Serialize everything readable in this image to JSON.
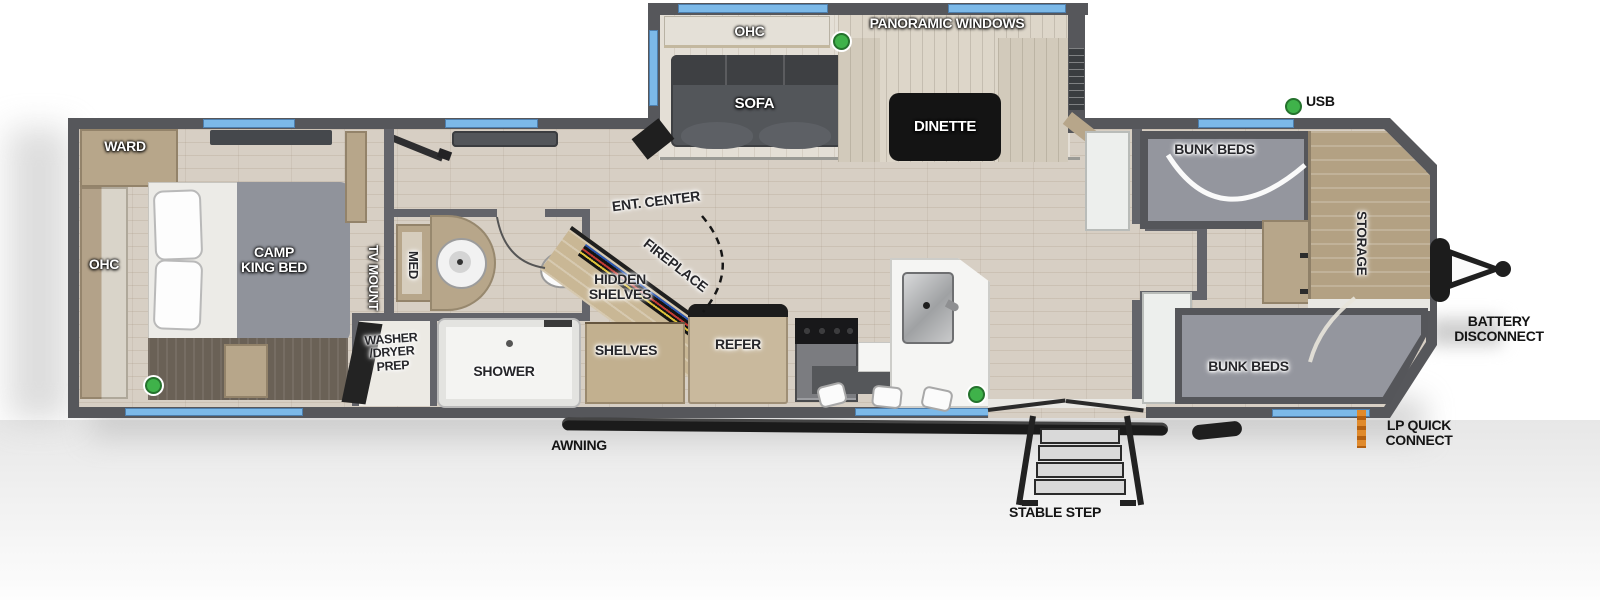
{
  "diagram_type": "travel-trailer-floorplan",
  "colors": {
    "window_blue": "#7cb9e8",
    "indicator_green": "#3fb24a",
    "lp_orange": "#dd7f1f",
    "wall_gray": "#5a5b5d",
    "floor_wood": "#d7cfc4",
    "cabinet_tan": "#b7a68a",
    "furniture_gray": "#94969e"
  },
  "labels": {
    "panoramic_windows": "PANORAMIC WINDOWS",
    "ohc_slide": "OHC",
    "sofa": "SOFA",
    "dinette": "DINETTE",
    "usb": "USB",
    "bunk_beds_upper": "BUNK BEDS",
    "storage": "STORAGE",
    "battery_disconnect": "BATTERY\nDISCONNECT",
    "bunk_beds_lower": "BUNK BEDS",
    "lp_quick_connect": "LP QUICK\nCONNECT",
    "stable_step": "STABLE STEP",
    "awning": "AWNING",
    "refer": "REFER",
    "shelves": "SHELVES",
    "hidden_shelves": "HIDDEN\nSHELVES",
    "fireplace": "FIREPLACE",
    "ent_center": "ENT. CENTER",
    "shower": "SHOWER",
    "washer_dryer_prep": "WASHER\n/DRYER\nPREP",
    "med": "MED",
    "tv_mount": "TV MOUNT",
    "camp_king_bed": "CAMP\nKING BED",
    "ohc_bedroom": "OHC",
    "ward": "WARD"
  }
}
